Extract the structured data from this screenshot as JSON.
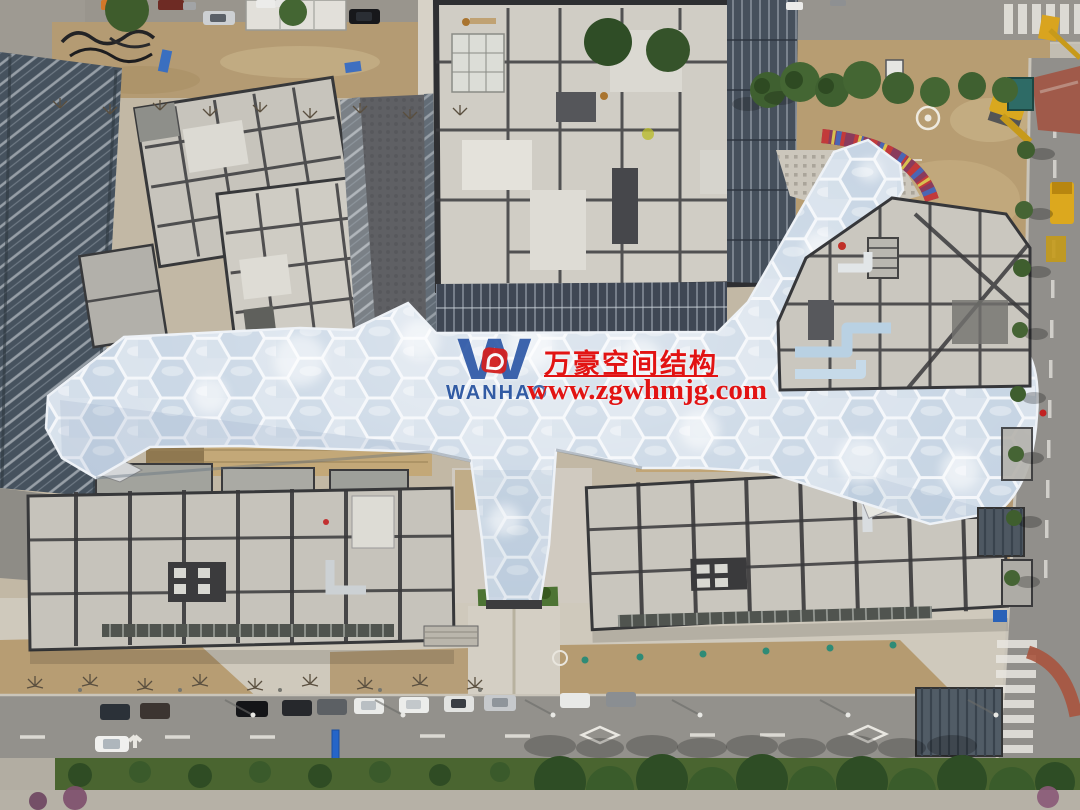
{
  "meta": {
    "type": "aerial-drone-photo",
    "subject": "Construction site of a commercial complex with a sprawling hexagonal ETFE cushion canopy connecting building blocks, surrounded by roads, parked cars and landscaping"
  },
  "watermark": {
    "logo_letter": "W",
    "logo_text": "WANHAO",
    "company_name": "万豪空间结构",
    "website": "www.zgwhmjg.com",
    "text_color": "#e21313",
    "logo_blue": "#2a55a5",
    "logo_red": "#d32020"
  },
  "scene": {
    "palette": {
      "canopy_cushion_light": "#d6e0eb",
      "canopy_cushion_blue": "#c3d2e2",
      "canopy_frame": "#f3f6fa",
      "concrete_roof": "#c7c4bc",
      "roof_seam": "#39393b",
      "dirt_ground": "#b49b73",
      "plaza_paving": "#d0cabf",
      "asphalt": "#93918c",
      "vegetation": "#3f5e2e",
      "glass_facade": "#46525e",
      "wood_deck": "#c3a878",
      "mural_red": "#c23a3a",
      "excavator_yellow": "#d9a41f"
    }
  }
}
